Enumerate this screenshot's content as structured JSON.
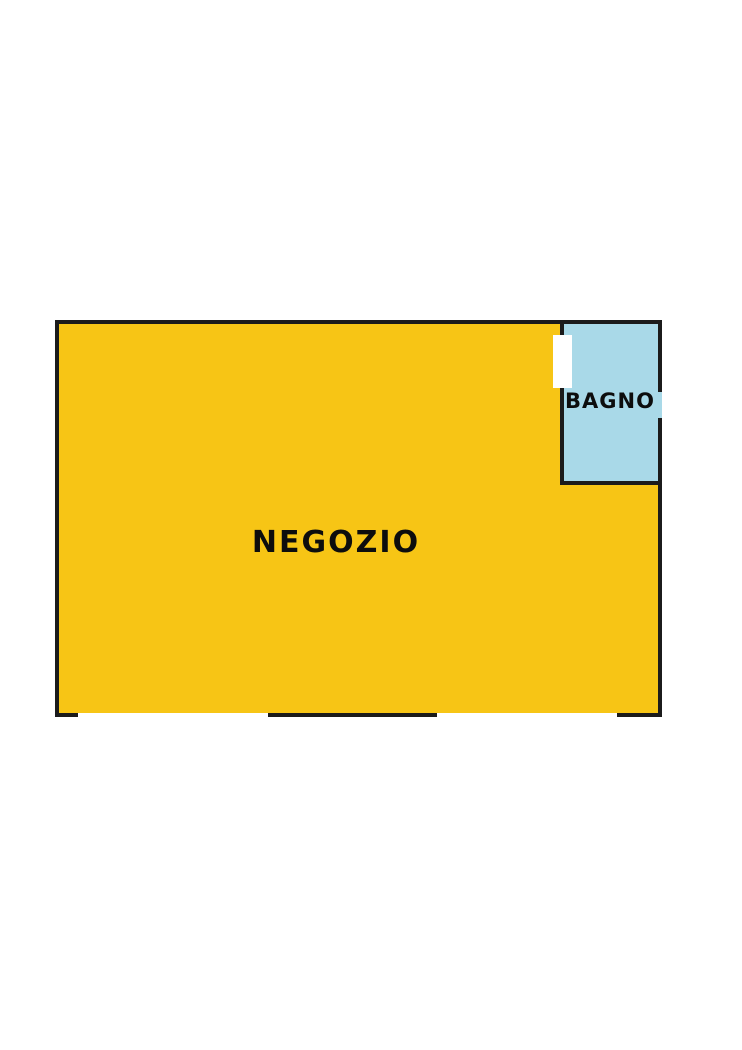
{
  "colors": {
    "background": "#ffffff",
    "wall": "#1b1b1b",
    "negozio_fill": "#f7c515",
    "bagno_fill": "#a9d9e8",
    "opening": "#ffffff",
    "label_text": "#0d0d0d"
  },
  "floorplan": {
    "negozio": {
      "label": "NEGOZIO"
    },
    "bagno": {
      "label": "BAGNO"
    }
  }
}
